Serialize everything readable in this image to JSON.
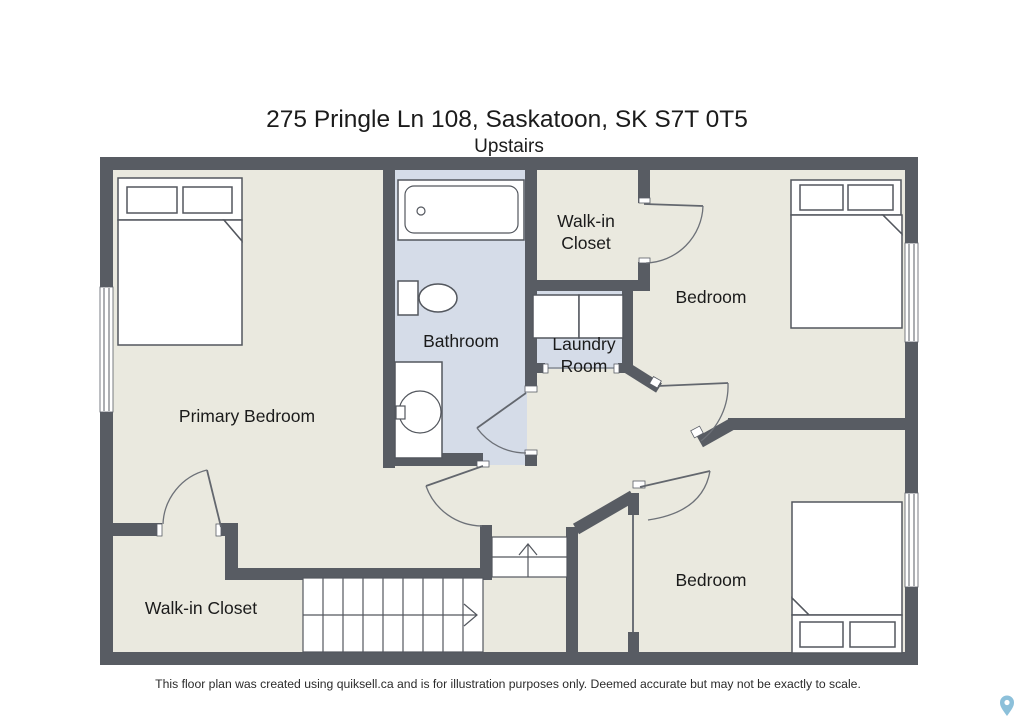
{
  "header": {
    "title": "275 Pringle Ln 108, Saskatoon, SK S7T 0T5",
    "subtitle": "Upstairs"
  },
  "rooms": {
    "primary_bedroom": {
      "label": "Primary Bedroom"
    },
    "bathroom": {
      "label": "Bathroom"
    },
    "walk_in_closet_top": {
      "line1": "Walk-in",
      "line2": "Closet"
    },
    "bedroom_top": {
      "label": "Bedroom"
    },
    "laundry_room": {
      "line1": "Laundry",
      "line2": "Room"
    },
    "bedroom_bottom": {
      "label": "Bedroom"
    },
    "walk_in_closet_bottom": {
      "label": "Walk-in Closet"
    }
  },
  "footer": {
    "disclaimer": "This floor plan was created using quiksell.ca and is for illustration purposes only. Deemed accurate but may not be exactly to scale."
  },
  "icons": {
    "location_pin": "location-pin-icon"
  },
  "colors": {
    "wall": "#585c63",
    "floor": "#eae9df",
    "wet_floor": "#d5dce8",
    "fixture_outline": "#53575e",
    "pin": "#78b5d4"
  }
}
